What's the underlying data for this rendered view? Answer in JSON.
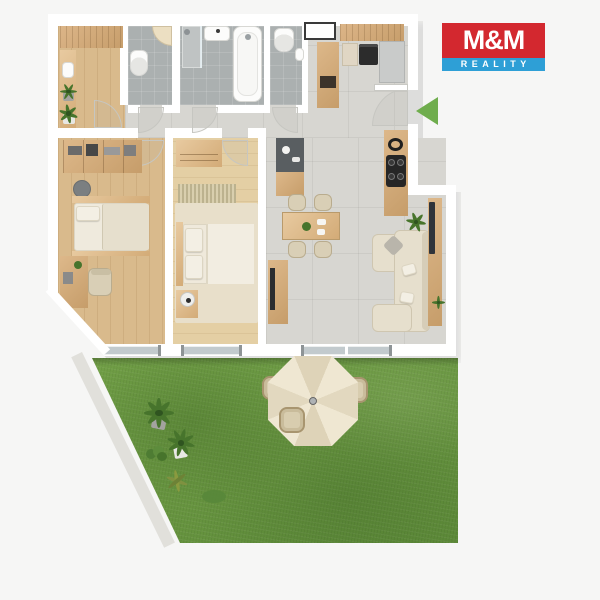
{
  "colors": {
    "bg": "#f6f6f5",
    "wall": "#ffffff",
    "wood_a": "#d9ba8c",
    "wood_b": "#e4cfa4",
    "tile": "#d7d6d1",
    "bath_tile": "#abb0b0",
    "grass_a": "#72a047",
    "grass_b": "#5f8c3a",
    "sofa": "#e6dfcd",
    "plant_green": "#47742c",
    "umbrella_a": "#efe7d2",
    "umbrella_b": "#e2d8bf",
    "logo_red": "#d3282f",
    "logo_blue": "#2e9fd6",
    "arrow_green": "#6fad4d"
  },
  "logo": {
    "title": "M&M",
    "subtitle": "REALITY"
  },
  "annotations": {
    "entrance_arrow": "green left-pointing arrow at apartment entrance door"
  },
  "scene": {
    "type": "3d-floor-plan-top-view of apartment with garden",
    "rooms": [
      {
        "name": "entry-hall",
        "floor": "wood",
        "furniture": [
          "wardrobe",
          "shelf-column",
          "picture-frame",
          "potted-plants"
        ]
      },
      {
        "name": "wc",
        "floor": "gray-tile",
        "furniture": [
          "toilet",
          "corner-washbasin"
        ]
      },
      {
        "name": "bathroom",
        "floor": "gray-tile",
        "furniture": [
          "shower",
          "washbasin",
          "bathtub"
        ]
      },
      {
        "name": "second-wc",
        "floor": "gray-tile",
        "furniture": [
          "toilet",
          "small-washbasin"
        ]
      },
      {
        "name": "kitchen",
        "floor": "tile",
        "furniture": [
          "open-shelf",
          "cabinet",
          "oven",
          "fridge",
          "tall-cabinet",
          "island-with-sink",
          "cooktop-counter"
        ]
      },
      {
        "name": "hallway",
        "floor": "tile",
        "furniture": [
          "door-swings"
        ]
      },
      {
        "name": "bedroom-1",
        "floor": "wood",
        "furniture": [
          "bookshelf",
          "single-bed",
          "stool",
          "desk",
          "desk-chair"
        ]
      },
      {
        "name": "bedroom-2",
        "floor": "light-wood",
        "furniture": [
          "wardrobe-dresser",
          "runner-rug",
          "double-bed",
          "nightstand",
          "side-table"
        ]
      },
      {
        "name": "living-dining",
        "floor": "tile",
        "furniture": [
          "dining-table",
          "four-chairs",
          "corner-sofa",
          "tv-console",
          "tv",
          "sideboard",
          "plants"
        ]
      },
      {
        "name": "garden",
        "floor": "grass",
        "furniture": [
          "parasol",
          "round-table",
          "four-garden-chairs",
          "potted-plants",
          "shrubs"
        ]
      }
    ]
  }
}
